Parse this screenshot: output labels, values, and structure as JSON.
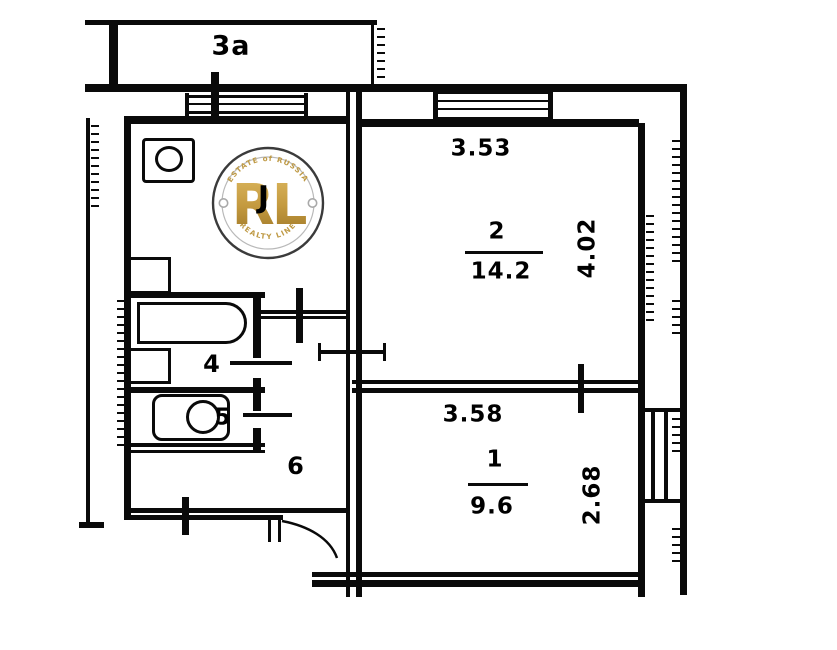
{
  "plan": {
    "balcony": {
      "label": "3a"
    },
    "rooms": {
      "living": {
        "number": "2",
        "area": "14.2",
        "width": "3.53",
        "depth": "4.02"
      },
      "bedroom": {
        "number": "1",
        "area": "9.6",
        "width": "3.58",
        "depth": "2.68"
      },
      "bathroom": {
        "number": "4"
      },
      "toilet": {
        "number": "5"
      },
      "hallway": {
        "number": "6"
      }
    },
    "covered_label": "J"
  },
  "watermark": {
    "arc_top": "ESTATE of RUSSIA",
    "monogram": "RL",
    "arc_bottom": "REALTY LINE",
    "gold": "#bf9a45"
  }
}
